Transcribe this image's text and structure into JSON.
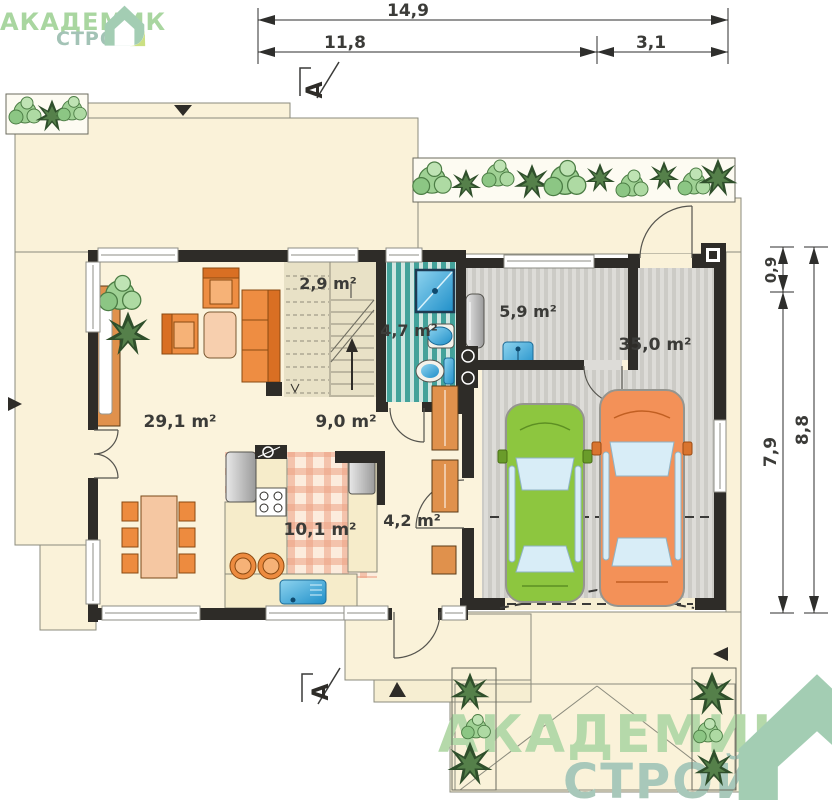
{
  "brand": {
    "name": "АКАДЕМИК",
    "sub": "СТРОЙ"
  },
  "section": {
    "label": "A"
  },
  "dimensions": {
    "top_total": "14,9",
    "top_left": "11,8",
    "top_right": "3,1",
    "right_upper": "0,9",
    "right_inner": "7,9",
    "right_outer": "8,8"
  },
  "rooms": [
    {
      "name": "living-room",
      "area": "29,1 m²"
    },
    {
      "name": "under-stairs-closet",
      "area": "2,9 m²"
    },
    {
      "name": "hall",
      "area": "9,0 m²"
    },
    {
      "name": "bathroom",
      "area": "4,7 m²"
    },
    {
      "name": "utility-room",
      "area": "5,9 m²"
    },
    {
      "name": "garage",
      "area": "35,0 m²"
    },
    {
      "name": "kitchen",
      "area": "10,1 m²"
    },
    {
      "name": "entry-hall",
      "area": "4,2 m²"
    }
  ],
  "colors": {
    "wall": "#2e2c28",
    "floor": "#fbf3dc",
    "terrace": "#faf2d9",
    "accent_orange": "#ee8d42",
    "car_green": "#8dc63f",
    "car_orange": "#f39158",
    "bath_teal": "#43a29a",
    "logo_green": "#b5d9aa",
    "logo_gray_green": "#a8c8ba"
  }
}
